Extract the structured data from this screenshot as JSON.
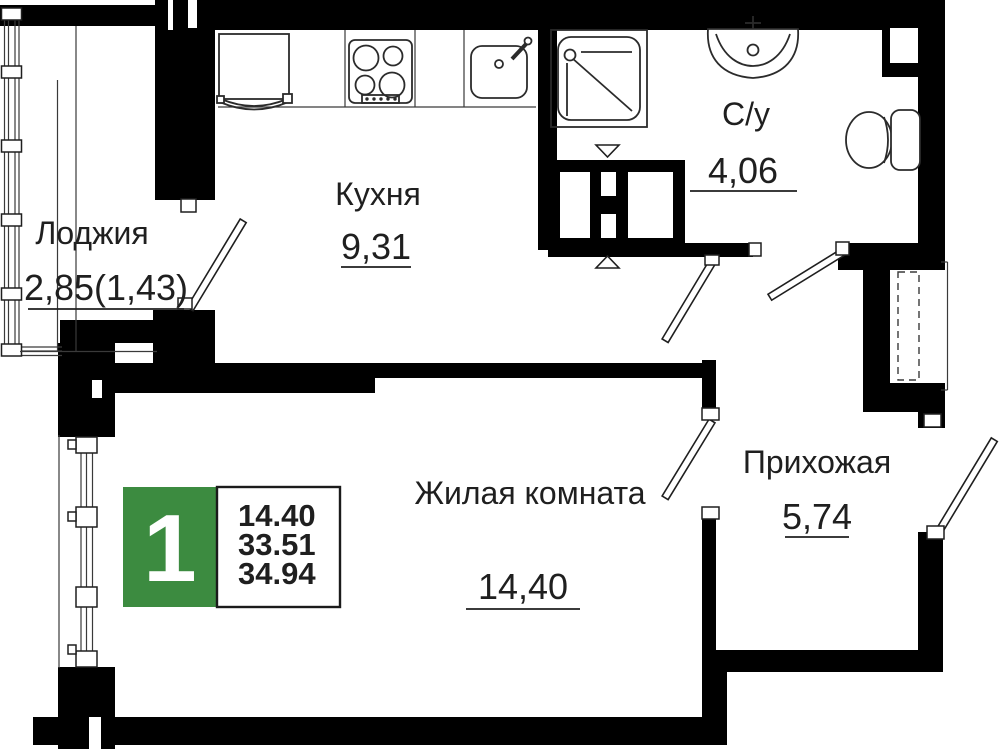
{
  "plan": {
    "type_badge": {
      "number": "1",
      "stats": [
        "14.40",
        "33.51",
        "34.94"
      ],
      "color": "#3c8b40",
      "text_color": "#ffffff"
    },
    "rooms": [
      {
        "id": "loggia",
        "name": "Лоджия",
        "area": "2,85(1,43)"
      },
      {
        "id": "kitchen",
        "name": "Кухня",
        "area": "9,31"
      },
      {
        "id": "bathroom",
        "name": "С/у",
        "area": "4,06"
      },
      {
        "id": "living",
        "name": "Жилая комната",
        "area": "14,40"
      },
      {
        "id": "hallway",
        "name": "Прихожая",
        "area": "5,74"
      }
    ],
    "fixtures": [
      "fridge",
      "stove-4-burner",
      "kitchen-sink",
      "shower-cabin",
      "washbasin",
      "toilet",
      "ventilation-shaft",
      "duct-dashed"
    ],
    "colors": {
      "walls": "#000000",
      "text": "#1f1f1f",
      "background": "#ffffff"
    }
  }
}
